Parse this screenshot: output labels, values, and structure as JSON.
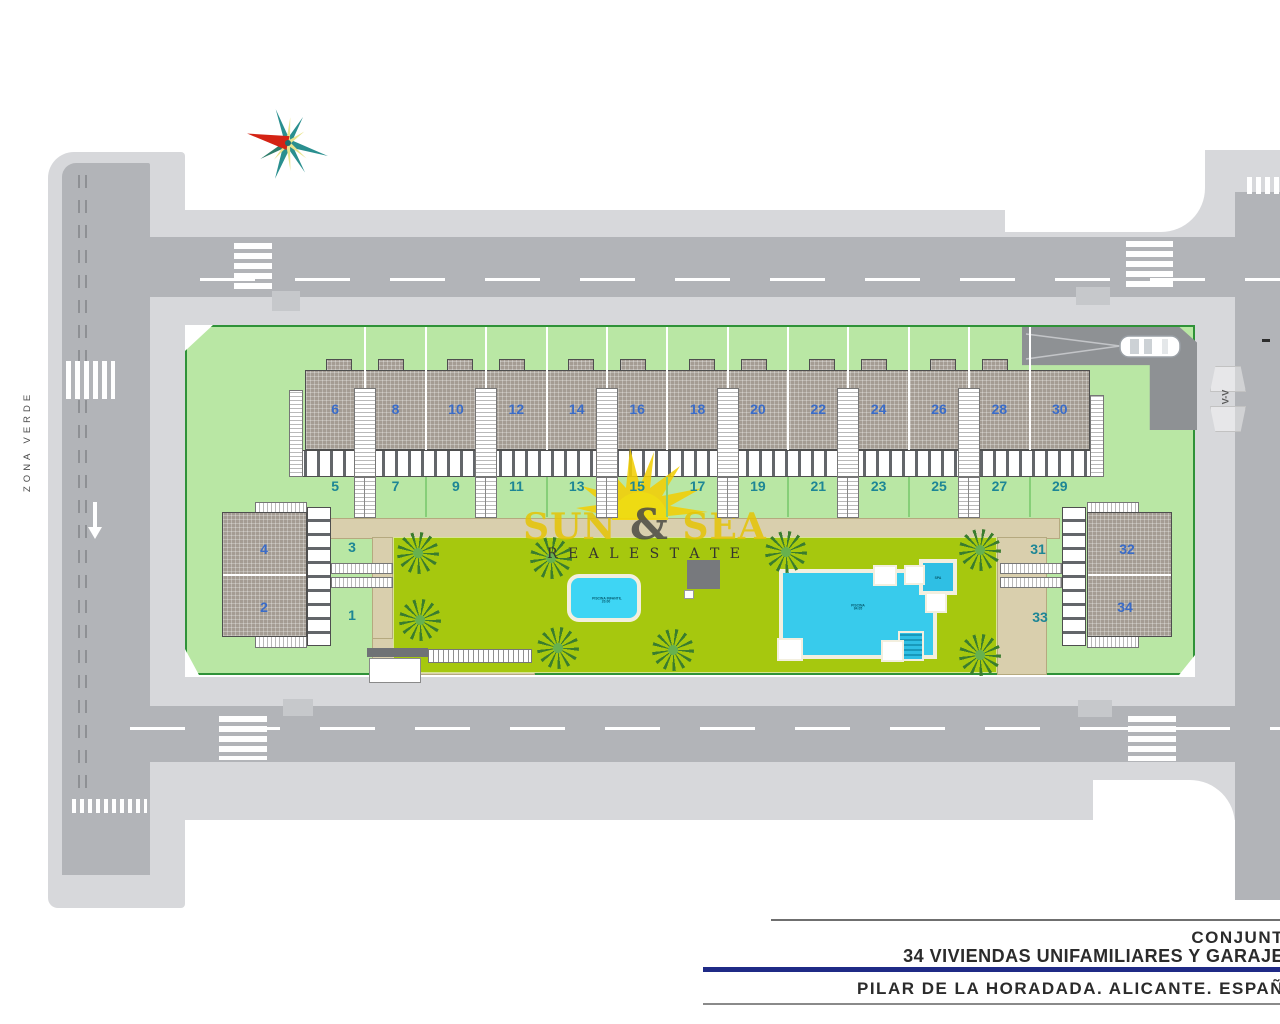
{
  "labels": {
    "zona_verde": "ZONA VERDE",
    "section_marker": "V-V"
  },
  "units": {
    "row_top": [
      "6",
      "8",
      "10",
      "12",
      "14",
      "16",
      "18",
      "20",
      "22",
      "24",
      "26",
      "28",
      "30"
    ],
    "row_bottom": [
      "5",
      "7",
      "9",
      "11",
      "13",
      "15",
      "17",
      "19",
      "21",
      "23",
      "25",
      "27",
      "29"
    ],
    "left_block": {
      "upper": "4",
      "lower": "2",
      "garden_upper": "3",
      "garden_lower": "1"
    },
    "right_block": {
      "upper": "32",
      "lower": "34",
      "garden_upper": "31",
      "garden_lower": "33"
    }
  },
  "pools": {
    "main_label_line1": "PISCINA",
    "main_label_line2": "84.05",
    "kids_label_line1": "PISCINA INFANTIL",
    "kids_label_line2": "20.00",
    "spa_label": "SPA"
  },
  "watermark": {
    "word1": "SUN",
    "amp": "&",
    "word2": "SEA",
    "tagline": "R E A L   E S T A T E"
  },
  "title_block": {
    "line1": "CONJUNT",
    "line2": "34 VIVIENDAS UNIFAMILIARES Y GARAJE",
    "line3": "PILAR DE LA HORADADA. ALICANTE. ESPAÑ"
  },
  "colors": {
    "parcel_green": "#b9e7a4",
    "parcel_border": "#2f9238",
    "lawn_olive": "#a6c80e",
    "road_gray": "#b2b4b8",
    "sidewalk_gray": "#d7d8db",
    "roof_gray": "#a49c93",
    "pool_blue": "#38cbec",
    "unit_number_blue": "#3a6cc8",
    "unit_number_teal": "#1d8695",
    "title_bar_blue": "#1f2a86",
    "watermark_yellow": "#e5c406",
    "compass_red": "#d42314",
    "compass_teal": "#2a8f8f"
  }
}
